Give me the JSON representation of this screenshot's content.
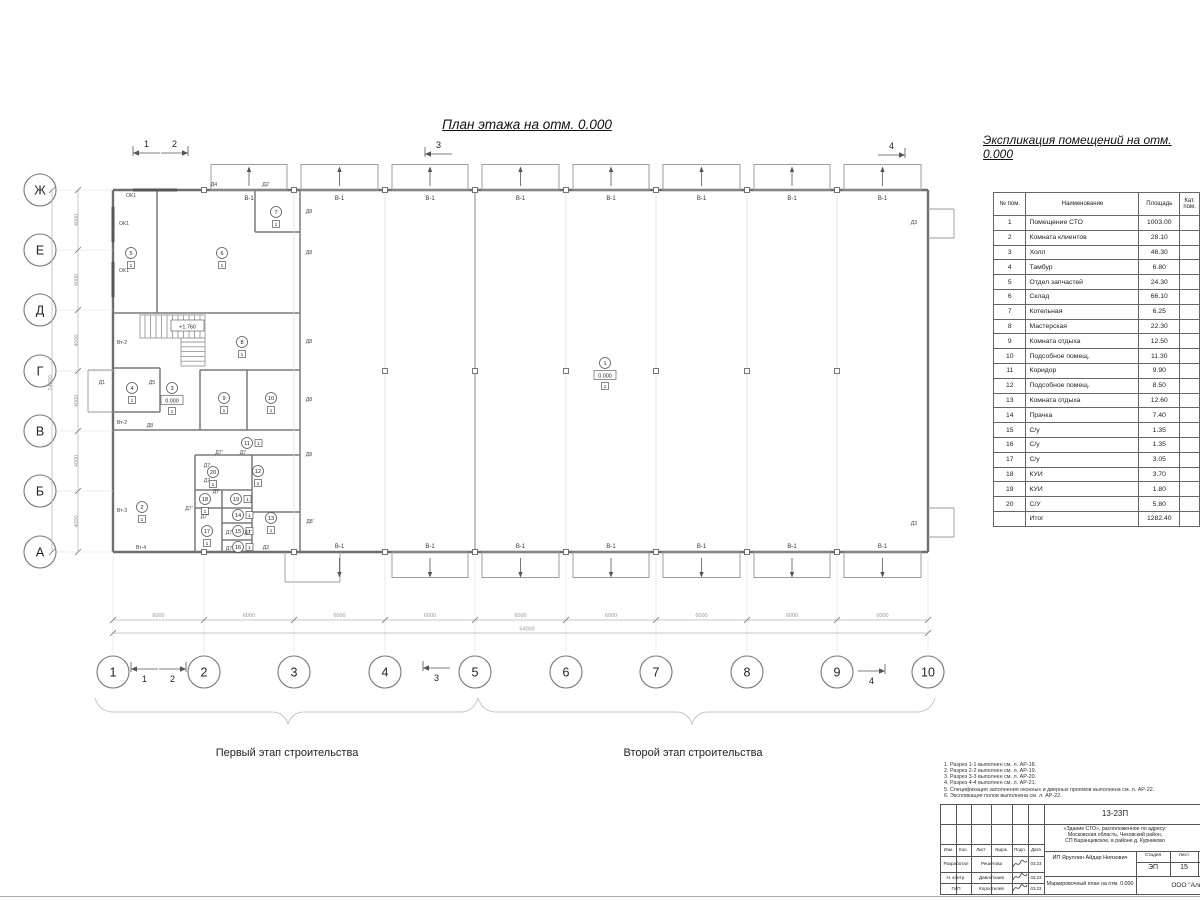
{
  "sheet": {
    "plan_title": "План этажа на отм. 0.000",
    "stage1": "Первый этап строительства",
    "stage2": "Второй этап строительства"
  },
  "explication": {
    "title": "Экспликация помещений на отм. 0.000",
    "col_num": "№ пом.",
    "col_name": "Наименование",
    "col_area": "Площадь",
    "col_cat": "Кат. пом.",
    "rows": [
      {
        "num": "1",
        "name": "Помещение СТО",
        "area": "1003.00"
      },
      {
        "num": "2",
        "name": "Комната клиентов",
        "area": "28.10"
      },
      {
        "num": "3",
        "name": "Холл",
        "area": "46.30"
      },
      {
        "num": "4",
        "name": "Тамбур",
        "area": "6.80"
      },
      {
        "num": "5",
        "name": "Отдел запчастей",
        "area": "24.30"
      },
      {
        "num": "6",
        "name": "Склад",
        "area": "66.10"
      },
      {
        "num": "7",
        "name": "Котельная",
        "area": "6.25"
      },
      {
        "num": "8",
        "name": "Мастерская",
        "area": "22.30"
      },
      {
        "num": "9",
        "name": "Комната отдыха",
        "area": "12.50"
      },
      {
        "num": "10",
        "name": "Подсобное помещ.",
        "area": "11.30"
      },
      {
        "num": "11",
        "name": "Коридор",
        "area": "9.90"
      },
      {
        "num": "12",
        "name": "Подсобное помещ.",
        "area": "8.50"
      },
      {
        "num": "13",
        "name": "Комната отдыха",
        "area": "12.60"
      },
      {
        "num": "14",
        "name": "Прачка",
        "area": "7.40"
      },
      {
        "num": "15",
        "name": "С/у",
        "area": "1.35"
      },
      {
        "num": "16",
        "name": "С/у",
        "area": "1.35"
      },
      {
        "num": "17",
        "name": "С/у",
        "area": "3.05"
      },
      {
        "num": "18",
        "name": "КУИ",
        "area": "3.70"
      },
      {
        "num": "19",
        "name": "КУИ",
        "area": "1.80"
      },
      {
        "num": "20",
        "name": "С/У",
        "area": "5.80"
      }
    ],
    "total_label": "Итог",
    "total_area": "1282.40"
  },
  "grid": {
    "row_axes": [
      "Ж",
      "Е",
      "Д",
      "Г",
      "В",
      "Б",
      "А"
    ],
    "col_axes": [
      "1",
      "2",
      "3",
      "4",
      "5",
      "6",
      "7",
      "8",
      "9",
      "10"
    ],
    "bay_dim": "6000",
    "total_width_dim": "54000",
    "row_dim": "4000",
    "total_height_dim": "24000"
  },
  "plan": {
    "gate_label": "В-1",
    "hall_level": "0.000",
    "stair_level": "+1.760",
    "floor_mark": "1",
    "rooms": [
      {
        "n": "1",
        "x": 605,
        "y": 363,
        "lvl": "0.000"
      },
      {
        "n": "2",
        "x": 142,
        "y": 507
      },
      {
        "n": "3",
        "x": 172,
        "y": 388,
        "lvl": "0.000"
      },
      {
        "n": "4",
        "x": 132,
        "y": 388
      },
      {
        "n": "5",
        "x": 131,
        "y": 253
      },
      {
        "n": "6",
        "x": 222,
        "y": 253
      },
      {
        "n": "7",
        "x": 276,
        "y": 212
      },
      {
        "n": "8",
        "x": 242,
        "y": 342
      },
      {
        "n": "9",
        "x": 224,
        "y": 398
      },
      {
        "n": "10",
        "x": 271,
        "y": 398
      },
      {
        "n": "11",
        "x": 247,
        "y": 443,
        "sq": "r"
      },
      {
        "n": "12",
        "x": 258,
        "y": 471
      },
      {
        "n": "13",
        "x": 271,
        "y": 518
      },
      {
        "n": "14",
        "x": 238,
        "y": 515,
        "sq": "r"
      },
      {
        "n": "15",
        "x": 238,
        "y": 531,
        "sq": "r"
      },
      {
        "n": "16",
        "x": 238,
        "y": 547,
        "sq": "r"
      },
      {
        "n": "17",
        "x": 207,
        "y": 531
      },
      {
        "n": "18",
        "x": 205,
        "y": 499
      },
      {
        "n": "19",
        "x": 236,
        "y": 499,
        "sq": "r"
      },
      {
        "n": "20",
        "x": 213,
        "y": 472
      }
    ],
    "labels": [
      {
        "t": "ОК1",
        "x": 131,
        "y": 197,
        "k": "window"
      },
      {
        "t": "ОК1",
        "x": 124,
        "y": 225,
        "k": "window"
      },
      {
        "t": "ОК1",
        "x": 124,
        "y": 272,
        "k": "window"
      },
      {
        "t": "Д4",
        "x": 214,
        "y": 186,
        "k": "door"
      },
      {
        "t": "Д2'",
        "x": 266,
        "y": 186,
        "k": "door"
      },
      {
        "t": "Д8",
        "x": 309,
        "y": 213,
        "k": "door"
      },
      {
        "t": "Д8",
        "x": 309,
        "y": 254,
        "k": "door"
      },
      {
        "t": "Д8",
        "x": 309,
        "y": 343,
        "k": "door"
      },
      {
        "t": "Д8",
        "x": 309,
        "y": 401,
        "k": "door"
      },
      {
        "t": "Д8",
        "x": 309,
        "y": 456,
        "k": "door"
      },
      {
        "t": "Д8'",
        "x": 310,
        "y": 523,
        "k": "door"
      },
      {
        "t": "Д8",
        "x": 150,
        "y": 427,
        "k": "door"
      },
      {
        "t": "Д1",
        "x": 102,
        "y": 384,
        "k": "door"
      },
      {
        "t": "Д5",
        "x": 152,
        "y": 384,
        "k": "door"
      },
      {
        "t": "Д3",
        "x": 914,
        "y": 224,
        "k": "door"
      },
      {
        "t": "Д3",
        "x": 914,
        "y": 525,
        "k": "door"
      },
      {
        "t": "Д2",
        "x": 266,
        "y": 549,
        "k": "door"
      },
      {
        "t": "Д7'",
        "x": 219,
        "y": 454,
        "k": "door"
      },
      {
        "t": "Д7",
        "x": 243,
        "y": 454,
        "k": "door"
      },
      {
        "t": "Д7",
        "x": 207,
        "y": 467,
        "k": "door"
      },
      {
        "t": "Д7",
        "x": 207,
        "y": 482,
        "k": "door"
      },
      {
        "t": "Д7",
        "x": 216,
        "y": 493,
        "k": "door"
      },
      {
        "t": "Д7'",
        "x": 189,
        "y": 510,
        "k": "door"
      },
      {
        "t": "Д7''",
        "x": 205,
        "y": 518,
        "k": "door"
      },
      {
        "t": "Д7",
        "x": 229,
        "y": 534,
        "k": "door"
      },
      {
        "t": "Д7'",
        "x": 248,
        "y": 534,
        "k": "door"
      },
      {
        "t": "Д7",
        "x": 229,
        "y": 550,
        "k": "door"
      },
      {
        "t": "Вт-2",
        "x": 122,
        "y": 344,
        "k": "vent"
      },
      {
        "t": "Вт-2",
        "x": 122,
        "y": 424,
        "k": "vent"
      },
      {
        "t": "Вт-3",
        "x": 122,
        "y": 512,
        "k": "vent"
      },
      {
        "t": "Вт-4",
        "x": 141,
        "y": 549,
        "k": "vent"
      }
    ]
  },
  "sections": [
    "1",
    "2",
    "3",
    "4"
  ],
  "notes": [
    "1. Разрез 1-1 выполнен см. л. АР-18.",
    "2. Разрез 2-2 выполнен см. л. АР-19.",
    "3. Разрез 3-3 выполнен см. л. АР-20.",
    "4. Разрез 4-4 выполнен см. л. АР-21.",
    "5. Спецификация заполнения оконных и дверных проемов выполнена см. л. АР-22.",
    "6. Экспликация полов выполнена см. л. АР-22."
  ],
  "titleblock": {
    "doc_code": "13-23П",
    "address_line1": "«Здание СТО», расположенное по адресу:",
    "address_line2": "Московская область, Чеховский район,",
    "address_line3": "СП Баранцевское, в районе д. Курниково",
    "h_izm": "Изм.",
    "h_kol": "Кол.",
    "h_list": "Лист",
    "h_ndok": "№док.",
    "h_podp": "Подл.",
    "h_data": "Дата",
    "r1_role": "Разработал",
    "r1_name": "Решетова",
    "r1_date": "03.23",
    "r2_role": "Н. контр.",
    "r2_name": "Давлетхаев",
    "r2_date": "03.23",
    "r3_role": "ГИП",
    "r3_name": "Коростелев",
    "r3_date": "03.23",
    "client": "ИП Яруллин Айдар Ниязович",
    "h_stage": "Стадия",
    "h_sheet": "Лист",
    "stage": "ЭП",
    "sheet_num": "15",
    "drawing_name": "Маркировочный план на отм. 0.000",
    "company": "ООО \"Алья"
  }
}
